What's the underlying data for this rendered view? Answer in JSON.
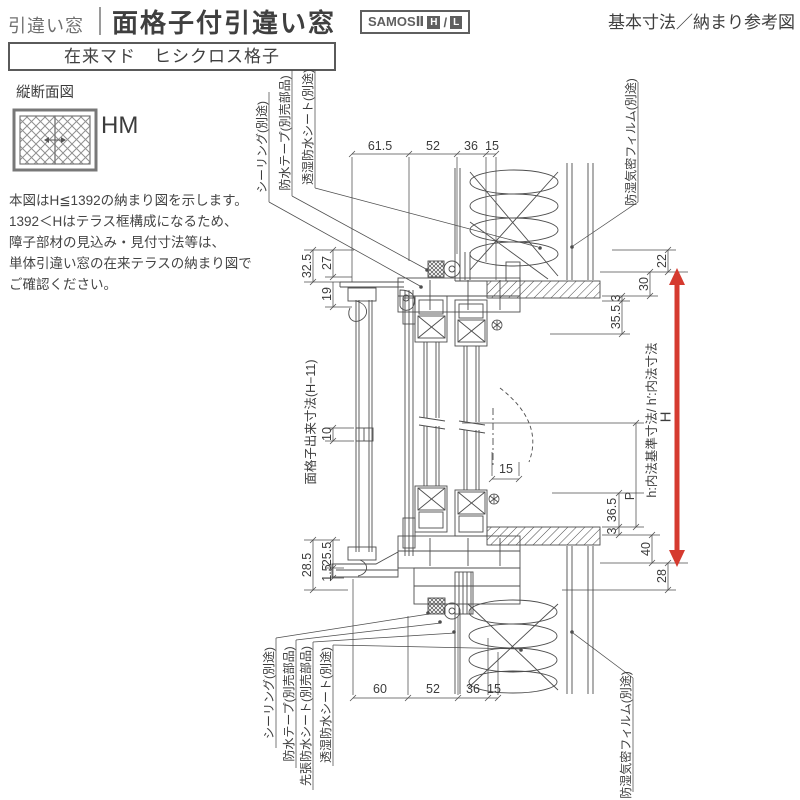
{
  "header": {
    "category": "引違い窓",
    "title": "面格子付引違い窓",
    "brand": "SAMOSⅡ",
    "brand_h": "H",
    "brand_slash": "/",
    "brand_l": "L",
    "corner_note": "基本寸法／納まり参考図",
    "variant": "在来マド　ヒシクロス格子"
  },
  "left_panel": {
    "section_label": "縦断面図",
    "window_code": "HM",
    "notes": [
      "本図はH≦1392の納まり図を示します。",
      "1392＜Hはテラス框構成になるため、",
      "障子部材の見込み・見付寸法等は、",
      "単体引違い窓の在来テラスの納まり図で",
      "ご確認ください。"
    ]
  },
  "drawing": {
    "leaders": {
      "top": [
        "シーリング(別途)",
        "防水テープ(別売部品)",
        "透湿防水シート(別途)"
      ],
      "top_right": "防湿気密フィルム(別途)",
      "bottom": [
        "シーリング(別途)",
        "防水テープ(別売部品)",
        "先張防水シート(別売部品)",
        "透湿防水シート(別途)"
      ],
      "bottom_right": "防湿気密フィルム(別途)"
    },
    "dims": {
      "top": [
        "61.5",
        "52",
        "36",
        "15"
      ],
      "bottom": [
        "60",
        "52",
        "36",
        "15"
      ],
      "left_top": [
        "32.5",
        "27",
        "19"
      ],
      "left_mid": "10",
      "left_bottom": [
        "25.5",
        "1.5",
        "28.5"
      ],
      "mid": "15",
      "right": [
        "22",
        "30",
        "3",
        "35.5",
        "36.5",
        "3",
        "40",
        "28"
      ],
      "p_label": "P"
    },
    "axis_labels": {
      "left": "面格子出来寸法(H−11)",
      "right": "h:内法基準寸法/ h′:内法寸法",
      "height": "H"
    },
    "colors": {
      "arrow_red": "#d53a2f",
      "line": "#4d4d4d"
    }
  }
}
